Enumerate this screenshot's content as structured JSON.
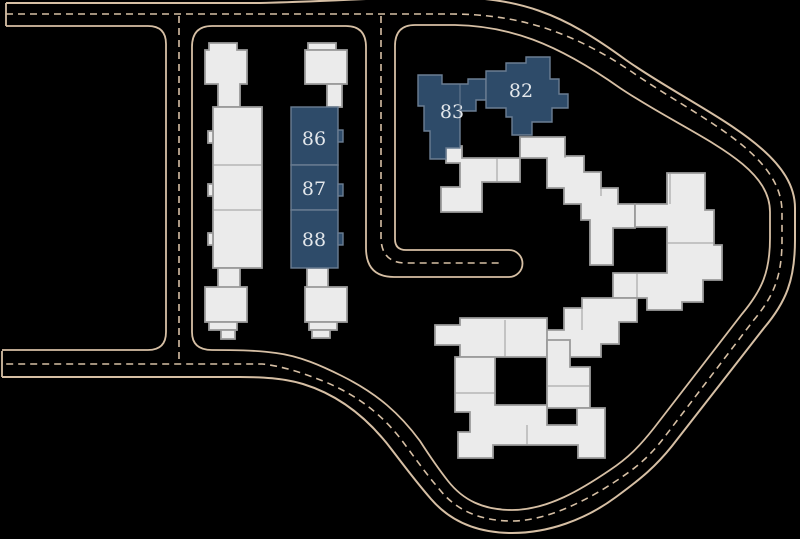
{
  "scene": {
    "type": "residential-site-plan",
    "background": "#000000"
  },
  "colors": {
    "bg": "#000000",
    "road": "#d6bfa4",
    "bldg_fill": "#ebebeb",
    "bldg_stroke": "#9b9b9b",
    "hl_fill": "#2e4b69",
    "hl_stroke": "#6b7e93",
    "label": "#e3e7eb"
  },
  "buildings": {
    "highlighted": [
      {
        "id": "82",
        "label": "82",
        "x": "521",
        "y": "91"
      },
      {
        "id": "83",
        "label": "83",
        "x": "452",
        "y": "112"
      },
      {
        "id": "86",
        "label": "86",
        "x": "314",
        "y": "139"
      },
      {
        "id": "87",
        "label": "87",
        "x": "314",
        "y": "189"
      },
      {
        "id": "88",
        "label": "88",
        "x": "314",
        "y": "240"
      }
    ]
  }
}
